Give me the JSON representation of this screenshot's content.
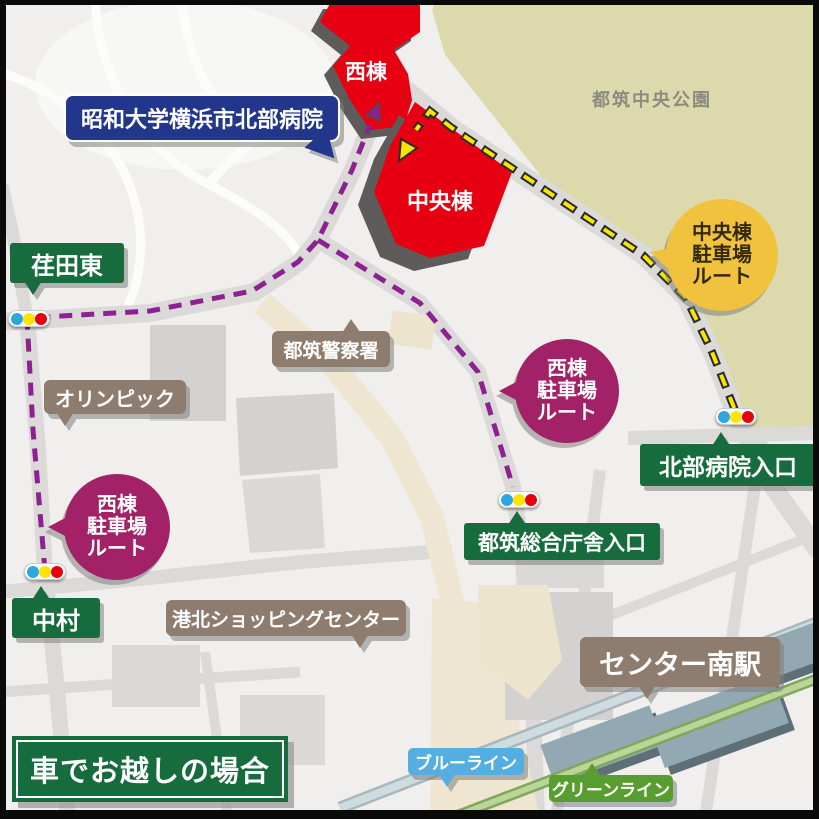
{
  "banner": {
    "label": "車でお越しの場合"
  },
  "hospital": {
    "name": "昭和大学横浜市北部病院",
    "west_wing": "西棟",
    "central_wing": "中央棟"
  },
  "park": {
    "name": "都筑中央公園"
  },
  "intersections": {
    "edahigashi": "荏田東",
    "nakamura": "中村",
    "hokubu_hospital_entrance": "北部病院入口",
    "tsuzuki_government_entrance": "都筑総合庁舎入口"
  },
  "landmarks": {
    "police": "都筑警察署",
    "olympic": "オリンピック",
    "kohoku_shopping_center": "港北ショッピングセンター",
    "center_minami_station": "センター南駅"
  },
  "rail_lines": {
    "blue": "ブルーライン",
    "green": "グリーンライン"
  },
  "route_bubbles": {
    "central_parking": {
      "line1": "中央棟",
      "line2": "駐車場",
      "line3": "ルート"
    },
    "west_parking": {
      "line1": "西棟",
      "line2": "駐車場",
      "line3": "ルート"
    }
  },
  "colors": {
    "hospital_red": "#E60012",
    "hospital_label_navy": "#22378C",
    "signal_label_green": "#166C3D",
    "banner_green": "#166C3D",
    "poi_label_brown": "#8E7D6E",
    "route_west_purple": "#8E2192",
    "route_central_yellow": "#F7E600",
    "bubble_magenta": "#A32166",
    "bubble_yellow": "#F0C23E",
    "blue_line_label": "#54AEE2",
    "green_line_label": "#579D30",
    "park_fill": "#DCDAAC"
  }
}
